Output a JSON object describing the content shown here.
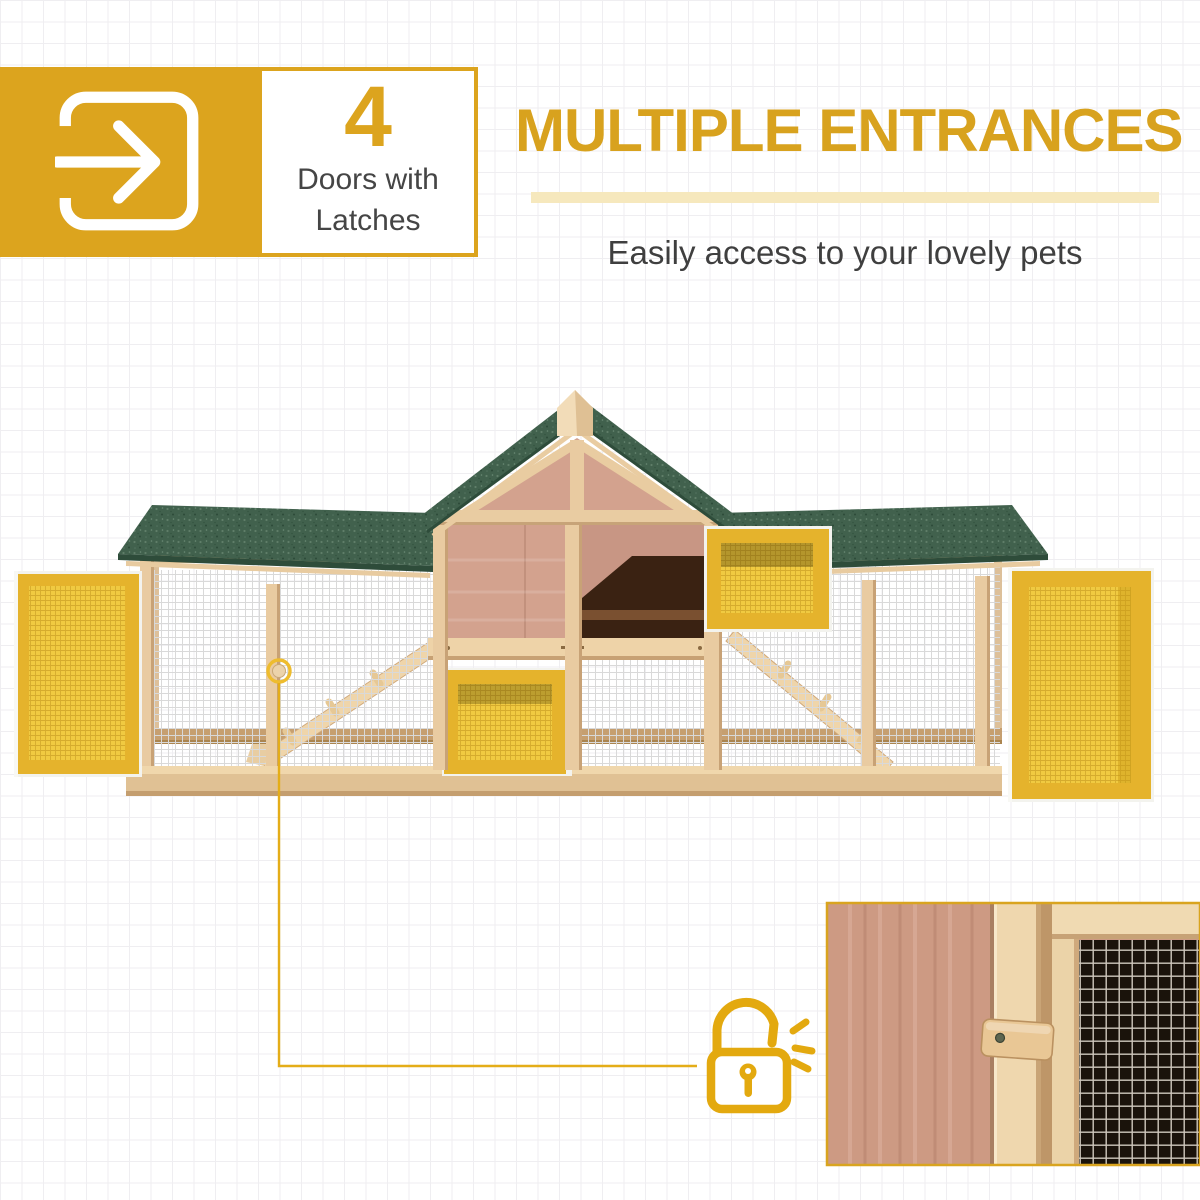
{
  "feature_badge": {
    "icon": "enter-door-arrow-icon",
    "count": "4",
    "label_line1": "Doors with",
    "label_line2": "Latches",
    "block_color": "#dca41e",
    "count_color": "#dca41e",
    "label_color": "#454545"
  },
  "headline": {
    "title": "MULTIPLE ENTRANCES",
    "subtitle": "Easily access to your lovely pets",
    "title_color": "#d8a21e",
    "underline_color": "#f6e8bd",
    "subtitle_color": "#3f3f3f"
  },
  "callout": {
    "marker_icon": "latch-ring-marker",
    "lock_icon": "unlocked-padlock-icon",
    "line_color": "#e4ad18"
  },
  "product_photo": {
    "subject_icon": "wooden-hutch-photo",
    "open_door_count": 4,
    "roof_color": "#41614d",
    "frame_wood_color": "#e9cba1",
    "panel_wood_color": "#d3a28e",
    "door_yellow": "#f0ca41",
    "door_frame_yellow": "#e5b32c",
    "mesh_color": "#d9d9d9"
  },
  "inset_photo": {
    "subject_icon": "door-latch-closeup-photo",
    "border_color": "#d9a41f"
  },
  "page": {
    "background_color": "#ffffff",
    "grid_color": "#efeef1"
  }
}
